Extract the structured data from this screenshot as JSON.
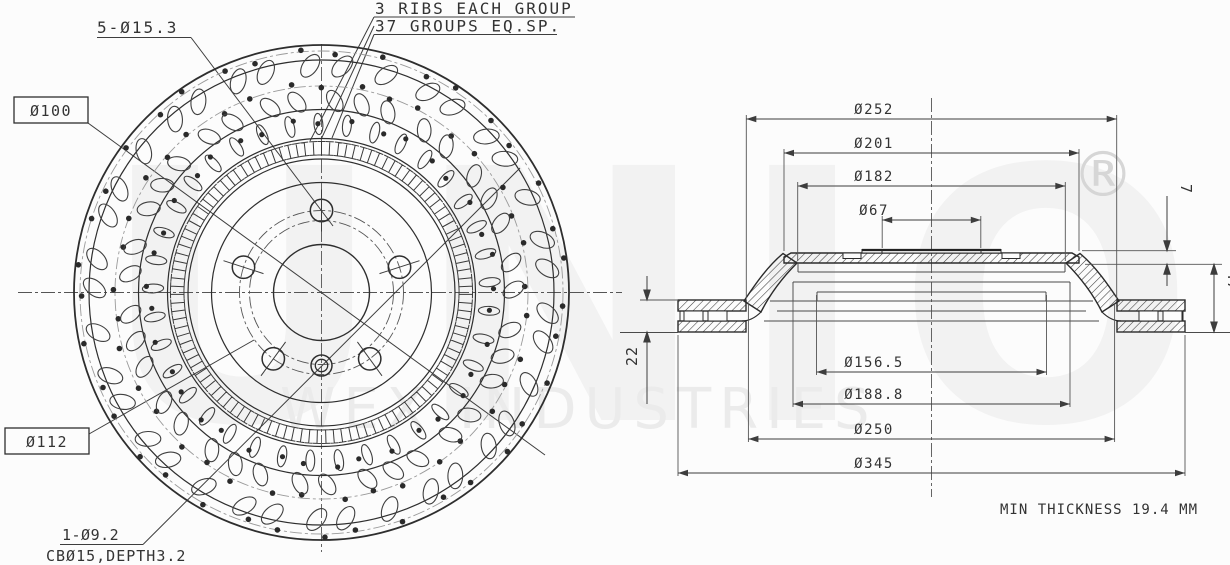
{
  "watermark": {
    "brand": "UNIO",
    "registered": "®",
    "subtitle": "WEX INDUSTRIES"
  },
  "front_view": {
    "bolt_holes_note": "5-Ø15.3",
    "rib_note_line1": "3 RIBS EACH GROUP",
    "rib_note_line2": "37 GROUPS EQ.SP.",
    "circle_label_100": "Ø100",
    "circle_label_112": "Ø112",
    "pin_hole_note": "1-Ø9.2",
    "pin_hole_counterbore_note": "CBØ15,DEPTH3.2"
  },
  "section_view": {
    "dims_top": [
      "Ø252",
      "Ø201",
      "Ø182",
      "Ø67"
    ],
    "dims_bottom": [
      "Ø156.5",
      "Ø188.8",
      "Ø250",
      "Ø345"
    ],
    "dim_thickness": "22",
    "dim_hat_offset": "7",
    "dim_overall_height": "47"
  },
  "footer_note": "MIN THICKNESS 19.4 MM",
  "colors": {
    "line": "#2e2e2e",
    "dim_line": "#3d3d3d",
    "watermark_light": "#f2f2f2",
    "watermark_mid": "#ebebeb",
    "watermark_reg": "#d6d6d6",
    "background": "#fcfcfc"
  }
}
